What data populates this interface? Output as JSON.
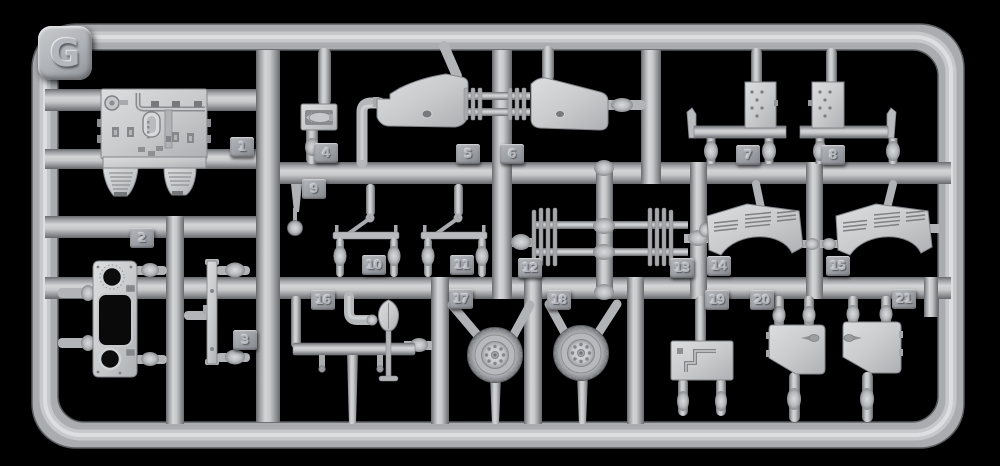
{
  "sprue": {
    "label": "G",
    "parts": [
      {
        "number": "1"
      },
      {
        "number": "2"
      },
      {
        "number": "3"
      },
      {
        "number": "4"
      },
      {
        "number": "5"
      },
      {
        "number": "6"
      },
      {
        "number": "7"
      },
      {
        "number": "8"
      },
      {
        "number": "9"
      },
      {
        "number": "10"
      },
      {
        "number": "11"
      },
      {
        "number": "12"
      },
      {
        "number": "13"
      },
      {
        "number": "14"
      },
      {
        "number": "15"
      },
      {
        "number": "16"
      },
      {
        "number": "17"
      },
      {
        "number": "18"
      },
      {
        "number": "19"
      },
      {
        "number": "20"
      },
      {
        "number": "21"
      }
    ],
    "colors": {
      "background": "#000000",
      "plastic": "#b4b6ba",
      "plastic_highlight": "#dfe0e2",
      "plastic_shadow": "#66686c",
      "tag_face": "#a0a3a8"
    }
  }
}
